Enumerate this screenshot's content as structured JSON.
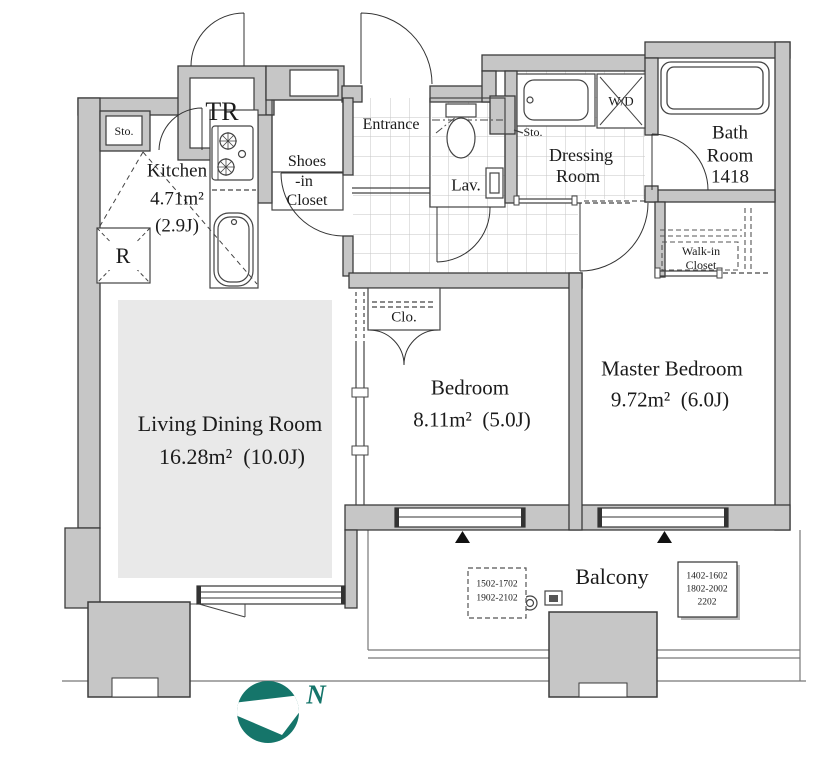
{
  "title": "Apartment floor plan 1LDK+2BR",
  "rooms": {
    "living_dining": {
      "name": "Living Dining Room",
      "area": "16.28m²  (10.0J)"
    },
    "bedroom": {
      "name": "Bedroom",
      "area": "8.11m²  (5.0J)"
    },
    "master_bedroom": {
      "name": "Master Bedroom",
      "area": "9.72m²  (6.0J)"
    },
    "kitchen": {
      "name": "Kitchen",
      "area": "4.71m²",
      "tatami": "(2.9J)"
    },
    "bath": {
      "line1": "Bath",
      "line2": "Room",
      "line3": "1418"
    },
    "dressing": {
      "line1": "Dressing",
      "line2": "Room"
    },
    "entrance": {
      "name": "Entrance"
    },
    "lavatory": {
      "name": "Lav."
    },
    "shoes_closet": {
      "line1": "Shoes",
      "line2": "-in",
      "line3": "Closet"
    },
    "walk_in_closet": {
      "line1": "Walk-in",
      "line2": "Closet"
    },
    "closet": {
      "name": "Clo."
    },
    "trunk_room": {
      "name": "TR"
    },
    "washer_dryer": {
      "name": "W/D"
    },
    "storage_kitchen": {
      "name": "Sto."
    },
    "storage_hall": {
      "name": "Sto."
    },
    "refrigerator": {
      "name": "R"
    },
    "balcony": {
      "name": "Balcony"
    }
  },
  "balcony_unit_notes": {
    "dashed_box": [
      "1502-1702",
      "1902-2102"
    ],
    "solid_box": [
      "1402-1602",
      "1802-2002",
      "2202"
    ]
  },
  "compass": {
    "label": "N",
    "color": "#15756a"
  }
}
